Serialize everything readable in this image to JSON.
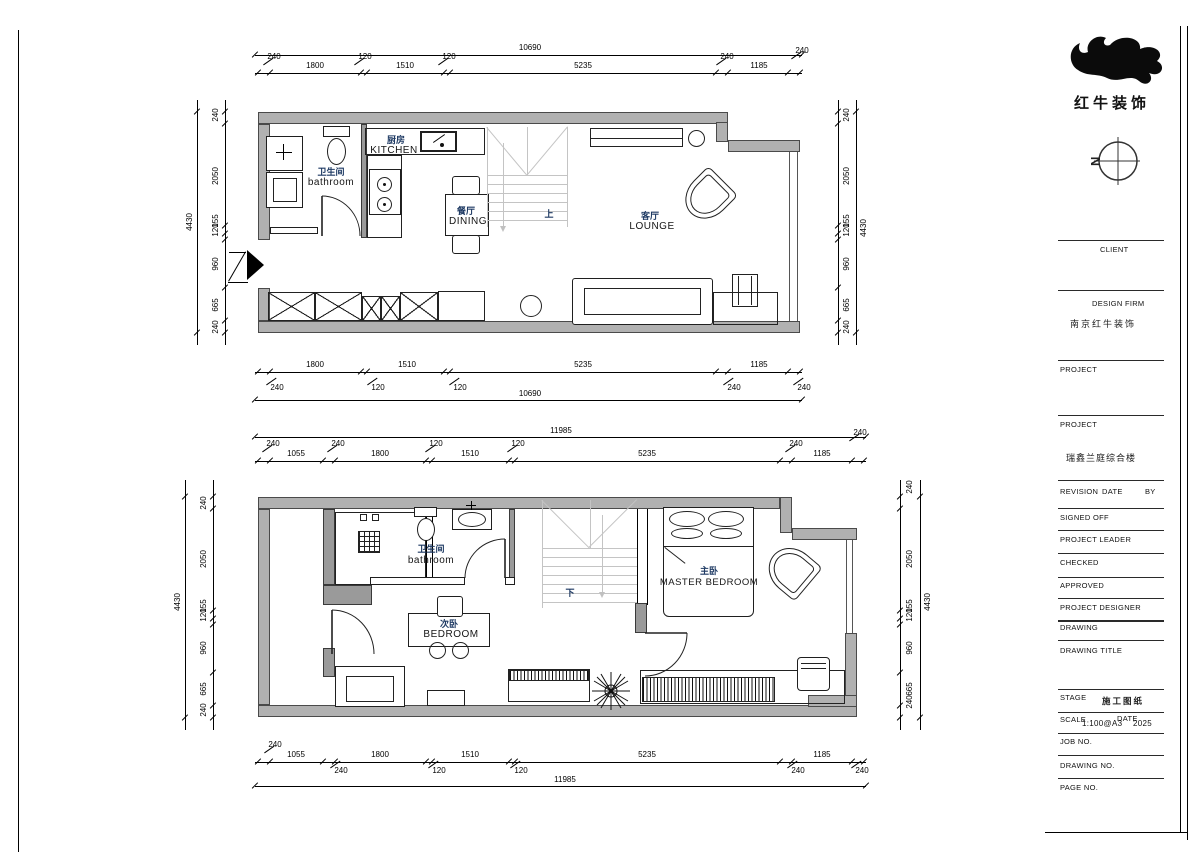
{
  "logo": {
    "company": "红牛装饰",
    "north": "N"
  },
  "titleblock": {
    "client": "CLIENT",
    "design_firm": "DESIGN FIRM",
    "design_firm_value": "南京红牛装饰",
    "project1": "PROJECT",
    "project2": "PROJECT",
    "project_value": "瑞鑫兰庭综合楼",
    "revision": "REVISION",
    "date": "DATE",
    "by": "BY",
    "signed_off": "SIGNED OFF",
    "project_leader": "PROJECT LEADER",
    "checked": "CHECKED",
    "approved": "APPROVED",
    "project_designer": "PROJECT DESIGNER",
    "drawing": "DRAWING",
    "drawing_title": "DRAWING TITLE",
    "stage": "STAGE",
    "stage_value": "施工图纸",
    "scale": "SCALE",
    "scale_value": "1:100@A3",
    "date2": "DATE",
    "date_value": "2025",
    "job_no": "JOB NO.",
    "drawing_no": "DRAWING NO.",
    "page_no": "PAGE NO."
  },
  "plan_upper": {
    "rooms": {
      "bathroom_cn": "卫生间",
      "bathroom_en": "bathroom",
      "kitchen_cn": "厨房",
      "kitchen_en": "KITCHEN",
      "dining_cn": "餐厅",
      "dining_en": "DINING",
      "lounge_cn": "客厅",
      "lounge_en": "LOUNGE",
      "stair": "上"
    },
    "dims": {
      "top_total": "10690",
      "top_main": [
        "1800",
        "1510",
        "5235",
        "1185"
      ],
      "top_small": [
        "240",
        "120",
        "120",
        "240",
        "240"
      ],
      "bottom_main": [
        "1800",
        "1510",
        "5235",
        "1185"
      ],
      "bottom_small": [
        "240",
        "120",
        "120",
        "240",
        "240"
      ],
      "bottom_total": "10690",
      "left_total": "4430",
      "left_segs": [
        "240",
        "2050",
        "155",
        "120",
        "960",
        "665",
        "240"
      ],
      "right_total": "4430",
      "right_segs": [
        "240",
        "2050",
        "155",
        "120",
        "960",
        "665",
        "240"
      ]
    }
  },
  "plan_lower": {
    "rooms": {
      "bathroom_cn": "卫生间",
      "bathroom_en": "bathroom",
      "bedroom_cn": "次卧",
      "bedroom_en": "BEDROOM",
      "master_cn": "主卧",
      "master_en": "MASTER  BEDROOM",
      "stair": "下"
    },
    "dims": {
      "top_total": "11985",
      "top_main": [
        "1055",
        "1800",
        "1510",
        "5235",
        "1185"
      ],
      "top_small": [
        "240",
        "240",
        "120",
        "120",
        "240",
        "240"
      ],
      "bottom_main": [
        "1055",
        "1800",
        "1510",
        "5235",
        "1185"
      ],
      "bottom_small": [
        "240",
        "240",
        "120",
        "120",
        "240",
        "240"
      ],
      "bottom_total": "11985",
      "left_total": "4430",
      "left_segs": [
        "240",
        "2050",
        "155",
        "120",
        "960",
        "665",
        "240"
      ],
      "right_total": "4430",
      "right_segs": [
        "240",
        "2050",
        "155",
        "120",
        "960",
        "665",
        "240"
      ]
    }
  }
}
